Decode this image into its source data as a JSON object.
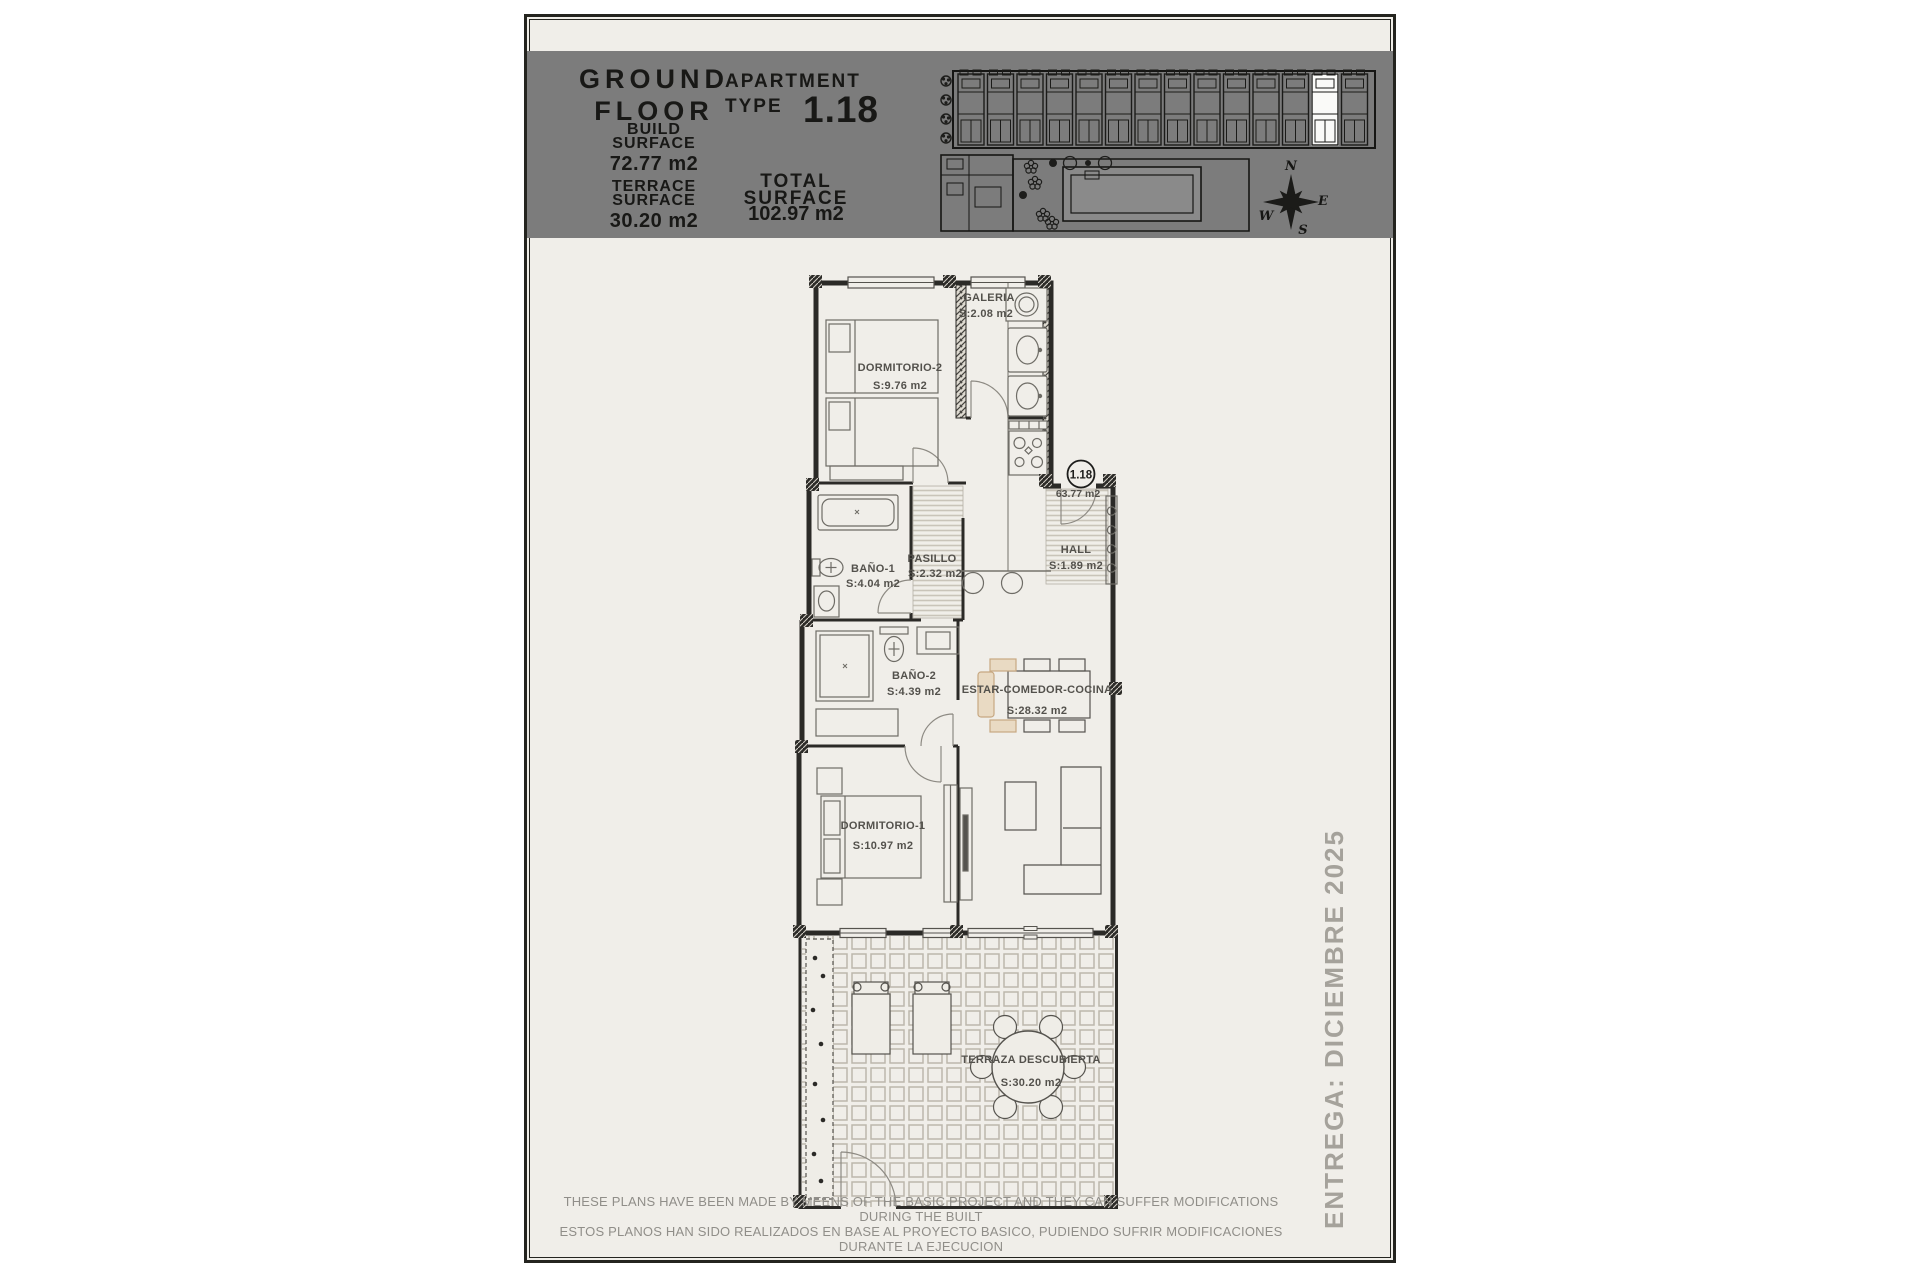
{
  "sheet": {
    "header": {
      "band_color": "#7c7c7c",
      "floor_line1": "GROUND",
      "floor_line2": "FLOOR",
      "build_label": "BUILD SURFACE",
      "build_label_1": "BUILD",
      "build_label_2": "SURFACE",
      "build_value": "72.77 m2",
      "terrace_label_1": "TERRACE",
      "terrace_label_2": "SURFACE",
      "terrace_value": "30.20 m2",
      "apt_label_1": "APARTMENT",
      "apt_label_2": "TYPE",
      "apt_number": "1.18",
      "total_label_1": "TOTAL",
      "total_label_2": "SURFACE",
      "total_value": "102.97 m2"
    },
    "compass": {
      "n": "N",
      "e": "E",
      "s": "S",
      "w": "W"
    },
    "plan": {
      "unit_badge": "1.18",
      "useful_surface": "63.77 m2",
      "accent_color": "#e9dac3",
      "rooms": [
        {
          "name": "DORMITORIO-2",
          "area": "S:9.76 m2"
        },
        {
          "name": "GALERIA",
          "area": "S:2.08 m2"
        },
        {
          "name": "BAÑO-1",
          "area": "S:4.04 m2"
        },
        {
          "name": "PASILLO",
          "area": "S:2.32 m2"
        },
        {
          "name": "HALL",
          "area": "S:1.89 m2"
        },
        {
          "name": "BAÑO-2",
          "area": "S:4.39 m2"
        },
        {
          "name": "ESTAR-COMEDOR-COCINA",
          "area": "S:28.32 m2"
        },
        {
          "name": "DORMITORIO-1",
          "area": "S:10.97 m2"
        },
        {
          "name": "TERRAZA DESCUBIERTA",
          "area": "S:30.20 m2"
        }
      ]
    },
    "delivery": "ENTREGA: DICIEMBRE 2025",
    "disclaimer_line1": "THESE PLANS HAVE BEEN MADE BY MEENS OF THE BASIC PROJECT AND THEY CAN SUFFER MODIFICATIONS DURING THE BUILT",
    "disclaimer_line2": "ESTOS PLANOS HAN SIDO REALIZADOS EN BASE AL PROYECTO BASICO, PUDIENDO SUFRIR MODIFICACIONES DURANTE LA EJECUCION"
  }
}
